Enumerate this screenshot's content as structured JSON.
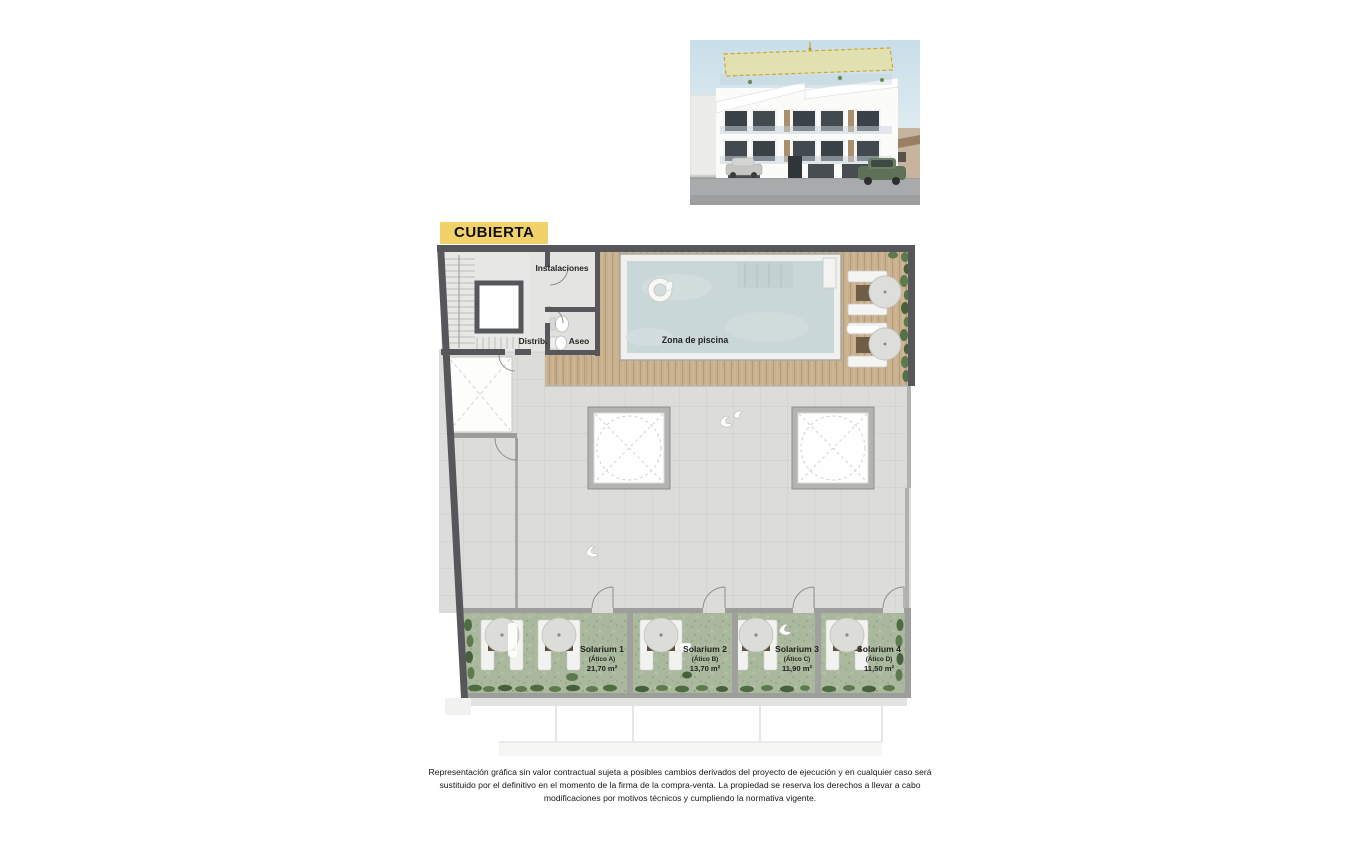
{
  "badge": {
    "label": "CUBIERTA"
  },
  "plan": {
    "labels": {
      "instalaciones": "Instalaciones",
      "distrib": "Distrib.",
      "aseo": "Aseo",
      "pool_zone": "Zona de piscina"
    },
    "solariums": [
      {
        "name": "Solarium 1",
        "unit": "(Ático A)",
        "area": "21,70 m²"
      },
      {
        "name": "Solarium 2",
        "unit": "(Ático B)",
        "area": "13,70 m²"
      },
      {
        "name": "Solarium 3",
        "unit": "(Ático C)",
        "area": "11,90 m²"
      },
      {
        "name": "Solarium 4",
        "unit": "(Ático D)",
        "area": "11,50 m²"
      }
    ]
  },
  "colors": {
    "highlight_yellow": "#f1d169",
    "wall_dark": "#55575a",
    "wall_light": "#9d9d9b",
    "deck_wood": "#c8af8d",
    "pool_water": "#cad7d8",
    "grass": "#aab89d",
    "terrace_tile": "#dcdcda",
    "plant_green": "#527043"
  },
  "disclaimer": {
    "text": "Representación gráfica sin valor contractual sujeta a posibles cambios derivados del proyecto de ejecución y en cualquier caso será sustituido por el definitivo en el momento de la firma de la compra-venta. La propiedad se reserva los derechos a llevar a cabo modificaciones por motivos técnicos y cumpliendo la normativa vigente."
  }
}
